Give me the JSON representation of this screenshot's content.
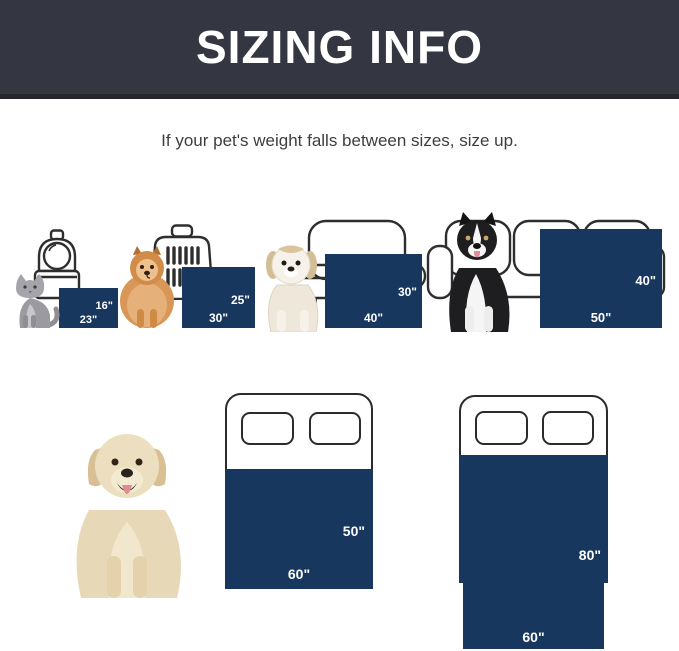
{
  "header": {
    "title": "SIZING INFO"
  },
  "subtitle": "If your pet's weight falls between sizes, size up.",
  "colors": {
    "blanket_navy": "#17375e",
    "header_bg": "#343641",
    "header_edge": "#25262c"
  },
  "size_chart": {
    "items": [
      {
        "pet": "cat",
        "furniture": "pet carrier",
        "width_label": "23\"",
        "height_label": "16\""
      },
      {
        "pet": "pomeranian",
        "furniture": "dog crate",
        "width_label": "30\"",
        "height_label": "25\""
      },
      {
        "pet": "puppy",
        "furniture": "loveseat sofa",
        "width_label": "40\"",
        "height_label": "30\""
      },
      {
        "pet": "border collie",
        "furniture": "three-seat sofa",
        "width_label": "50\"",
        "height_label": "40\""
      }
    ]
  },
  "bed_chart": {
    "pet": "golden retriever",
    "beds": [
      {
        "width_label": "60\"",
        "height_label": "50\""
      },
      {
        "width_label": "60\"",
        "height_label": "80\""
      }
    ]
  }
}
